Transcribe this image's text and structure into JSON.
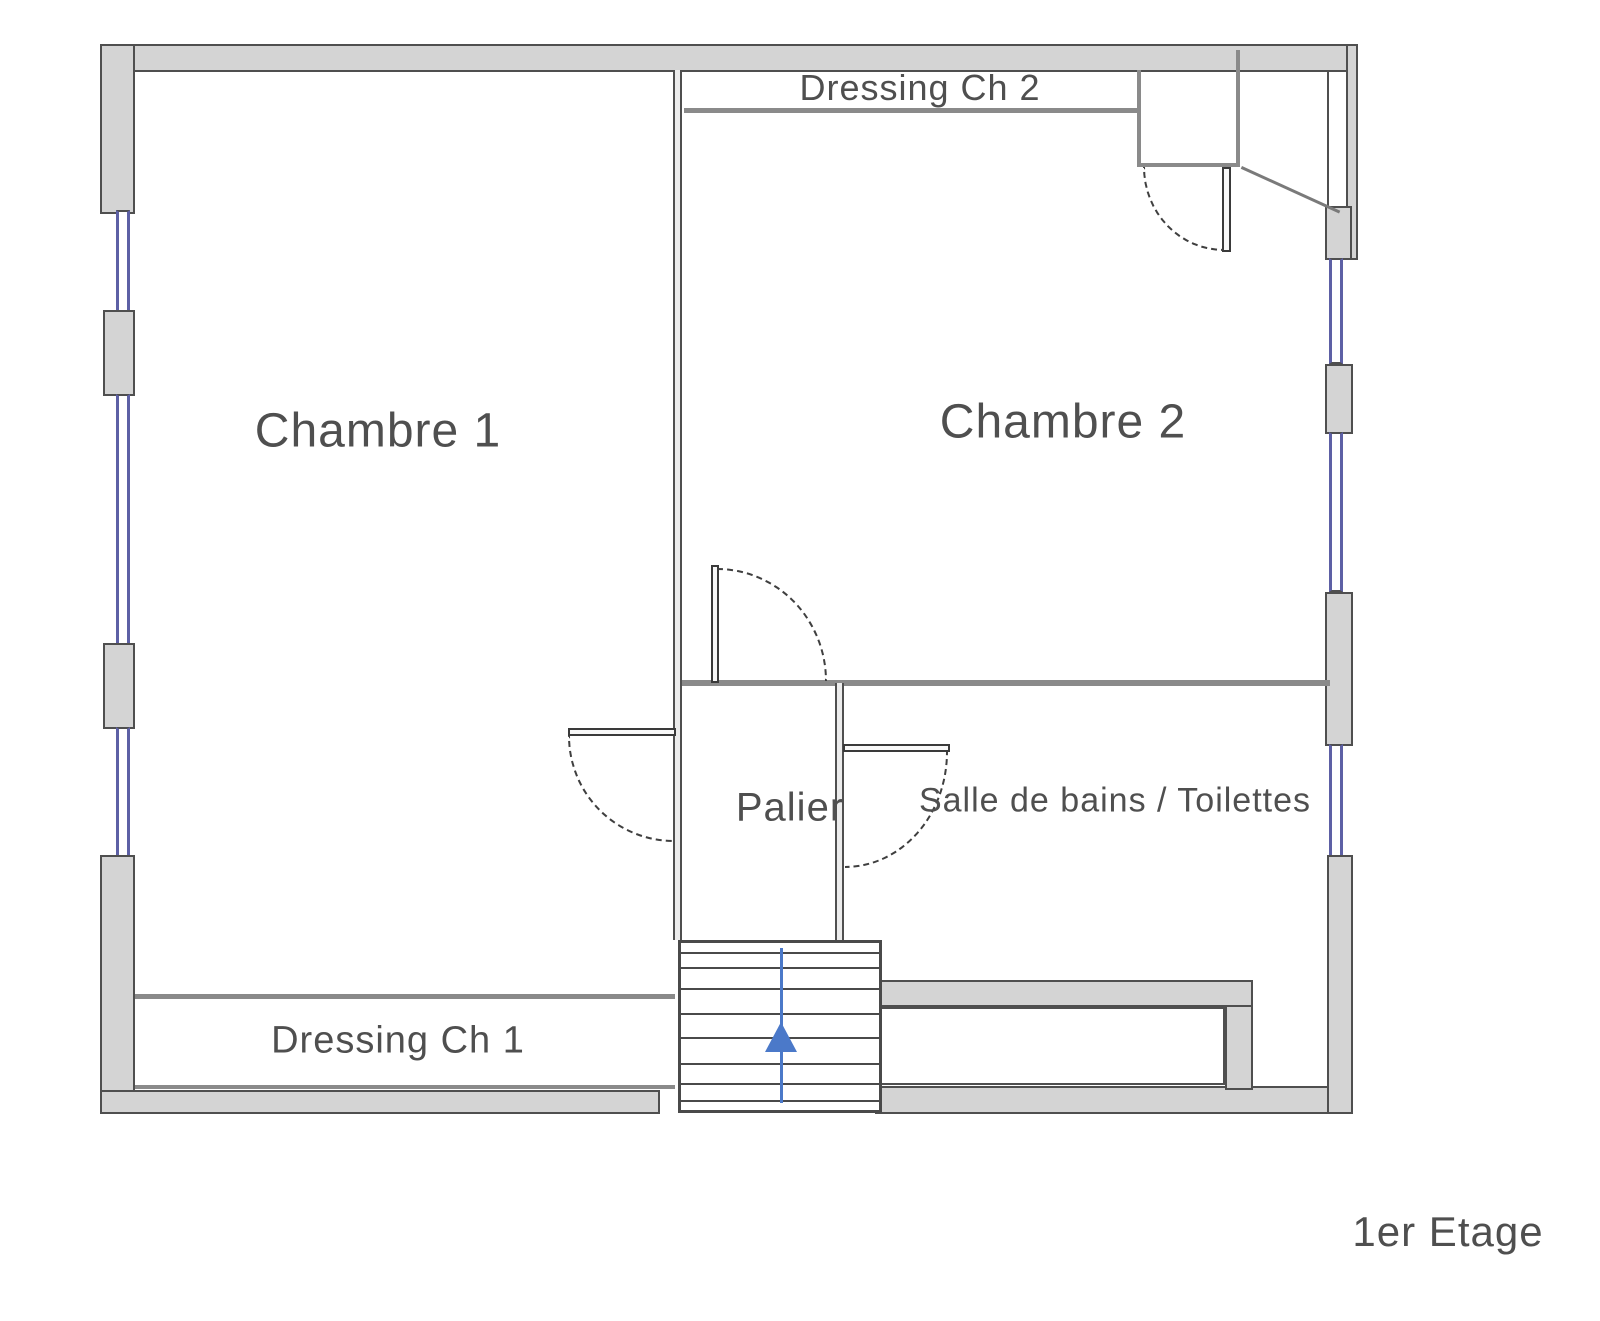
{
  "rooms": {
    "chambre1": {
      "label": "Chambre 1"
    },
    "chambre2": {
      "label": "Chambre 2"
    },
    "palier": {
      "label": "Palier"
    },
    "salle_de_bains": {
      "label": "Salle de bains / Toilettes"
    },
    "dressing_ch1": {
      "label": "Dressing Ch 1"
    },
    "dressing_ch2": {
      "label": "Dressing Ch 2"
    }
  },
  "floor": {
    "label": "1er Etage"
  },
  "stairs": {
    "arrow_direction": "up"
  },
  "colors": {
    "wall_fill": "#d4d4d4",
    "wall_line": "#4f4f4f",
    "thin_wall": "#8a8a8a",
    "window_blue": "#5d60a5",
    "stair_arrow": "#4b79c9",
    "label_text": "#4f4f4f"
  }
}
